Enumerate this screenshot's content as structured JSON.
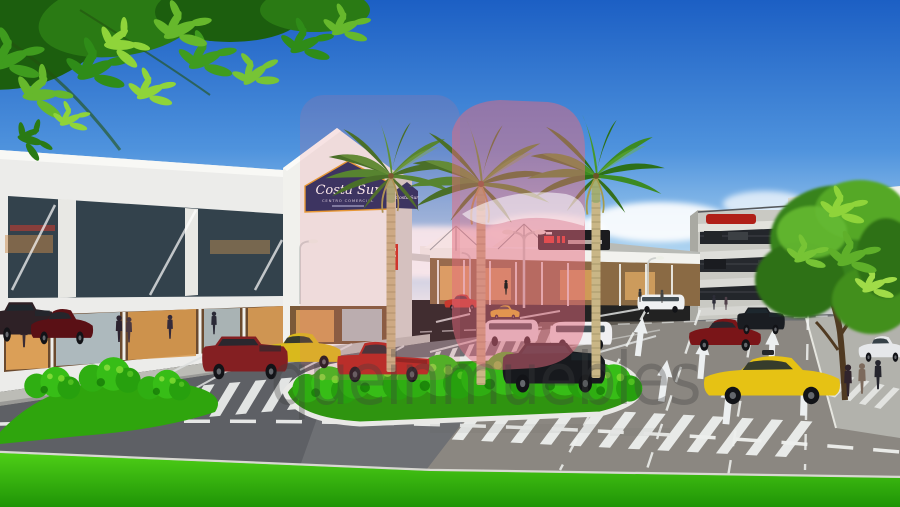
{
  "scene": {
    "description": "Architectural rendering of Costa Sur shopping center exterior with palm-lined parking lot, landscaped roundabout, crosswalks, parking garage and overhanging foliage"
  },
  "signs": {
    "main": {
      "script": "Costa Sur",
      "line2": "CENTRO COMERCIAL"
    },
    "tower": {
      "script": "Costa Sur"
    }
  },
  "watermark": {
    "text": "queinmuebles"
  },
  "palette": {
    "sky_top": "#1c5fc4",
    "sky_mid": "#4f93dd",
    "sky_low": "#a8d0ef",
    "sky_horizon": "#e8f4fb",
    "grass_light": "#4ecf17",
    "grass_deep": "#1f9406",
    "asphalt": "#6e7074",
    "sunlit_road": "#b3a894",
    "building_white": "#ececе8",
    "sign_navy": "#1d2a5c",
    "sign_trim": "#e8a028",
    "sign_text": "#ffffff",
    "watermark_pink": "#e4697e",
    "watermark_gray": "#3f3f3f",
    "palm_frond": "#2d7018",
    "palm_trunk": "#c9b686",
    "shrub_green": "#2fae12"
  },
  "vehicles": [
    {
      "name": "suv-dark-red",
      "color": "#841f22"
    },
    {
      "name": "sedan-yellow",
      "color": "#d9b91c"
    },
    {
      "name": "pickup-red",
      "color": "#b2231b"
    },
    {
      "name": "suv-black-center",
      "color": "#17191d"
    },
    {
      "name": "van-white-1",
      "color": "#e9ebee"
    },
    {
      "name": "van-white-2",
      "color": "#f0f0f2"
    },
    {
      "name": "sedan-red-distant",
      "color": "#c03020"
    },
    {
      "name": "hatch-yellow-small",
      "color": "#e0c020"
    },
    {
      "name": "wagon-dark-red-right",
      "color": "#7a1518"
    },
    {
      "name": "suv-black-right",
      "color": "#1a1d22"
    },
    {
      "name": "taxi-yellow",
      "color": "#e6c214"
    },
    {
      "name": "suv-dark-left",
      "color": "#2e2126"
    },
    {
      "name": "sedan-maroon-left",
      "color": "#5a1015"
    },
    {
      "name": "sedan-white-right",
      "color": "#e6e8ea"
    },
    {
      "name": "van-white-distant",
      "color": "#eef0f2"
    }
  ]
}
